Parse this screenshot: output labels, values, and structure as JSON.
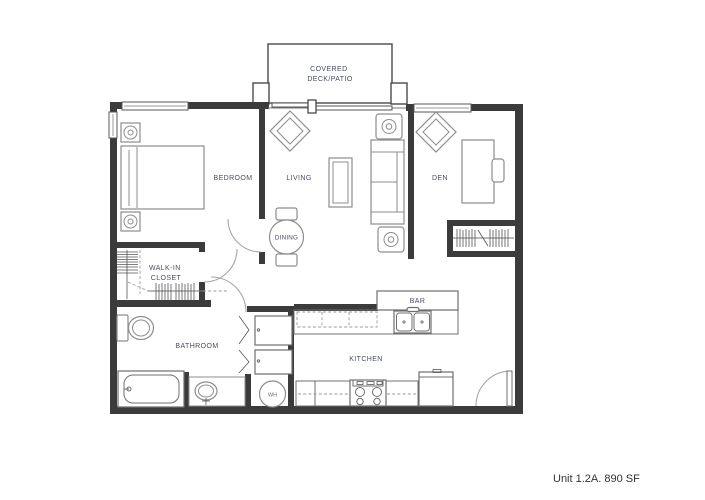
{
  "plan": {
    "rooms": {
      "deck": {
        "line1": "COVERED",
        "line2": "DECK/PATIO"
      },
      "bedroom": {
        "label": "BEDROOM"
      },
      "living": {
        "label": "LIVING"
      },
      "den": {
        "label": "DEN"
      },
      "dining": {
        "label": "DINING"
      },
      "walk_in_closet": {
        "line1": "WALK-IN",
        "line2": "CLOSET"
      },
      "bathroom": {
        "label": "BATHROOM"
      },
      "bar": {
        "label": "BAR"
      },
      "kitchen": {
        "label": "KITCHEN"
      },
      "water_heater": {
        "label": "WH"
      }
    },
    "unit_label": "Unit 1.2A. 890 SF",
    "colors": {
      "wall": "#3b3b3b",
      "furniture_line": "#8d8d8d",
      "label_text": "#474e61",
      "background": "#ffffff"
    }
  }
}
